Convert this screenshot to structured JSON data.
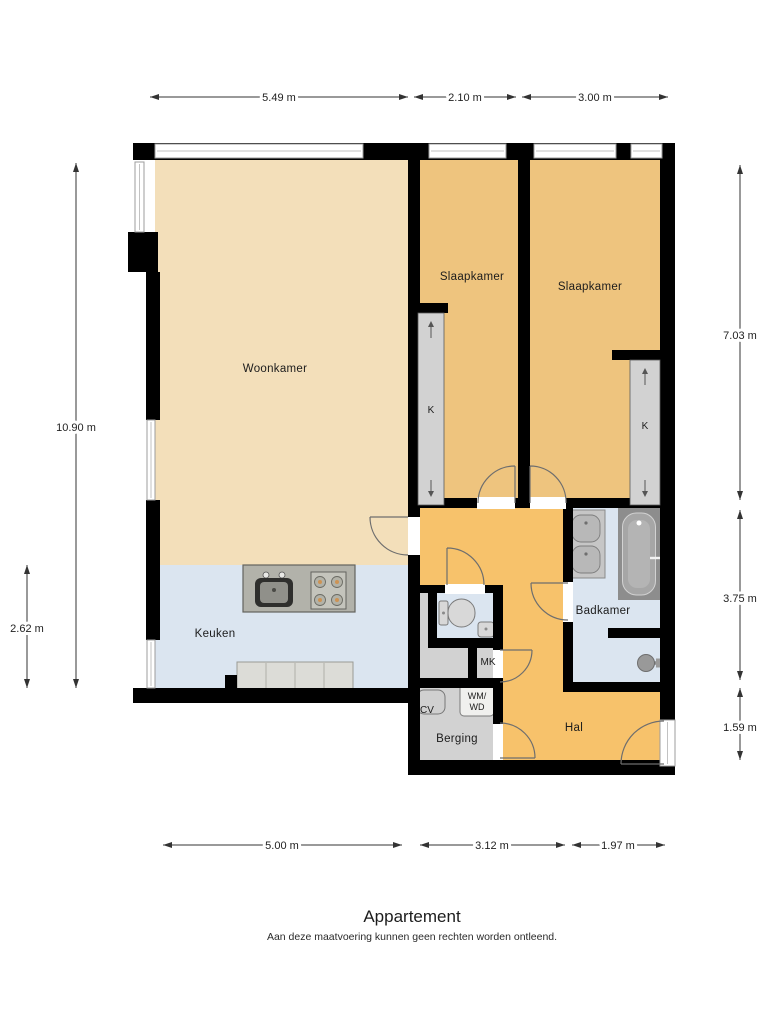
{
  "title": "Appartement",
  "disclaimer": "Aan deze maatvoering kunnen geen rechten worden ontleend.",
  "rooms": {
    "woonkamer": "Woonkamer",
    "slaapkamer_links": "Slaapkamer",
    "slaapkamer_rechts": "Slaapkamer",
    "keuken": "Keuken",
    "badkamer": "Badkamer",
    "hal": "Hal",
    "berging": "Berging",
    "mk": "MK",
    "cv": "CV",
    "wm_wd": [
      "WM/",
      "WD"
    ],
    "kast_links": "K",
    "kast_rechts": "K"
  },
  "dimensions": {
    "top": [
      "5.49 m",
      "2.10 m",
      "3.00 m"
    ],
    "left": [
      "10.90 m",
      "2.62 m"
    ],
    "right": [
      "7.03 m",
      "3.75 m",
      "1.59 m"
    ],
    "bottom": [
      "5.00 m",
      "3.12 m",
      "1.97 m"
    ]
  },
  "colors": {
    "living": "#f3dfba",
    "bedroom": "#eec47e",
    "hall": "#f7c26b",
    "wet_room": "#dbe5f0",
    "storage": "#d2d2d2",
    "wall": "#000000",
    "counter": "#b2b2aa",
    "counter_light": "#dcdcd7",
    "fixture": "#d8d8d8",
    "tub_dark": "#8d8d8d"
  }
}
